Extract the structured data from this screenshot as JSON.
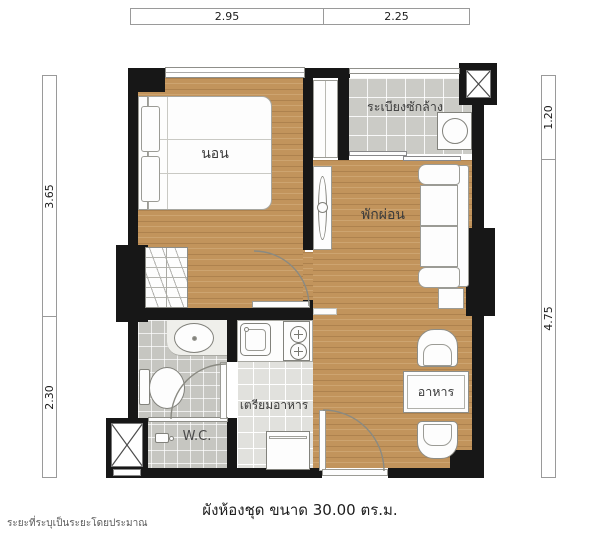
{
  "dimensions": {
    "top": [
      {
        "label": "2.95"
      },
      {
        "label": "2.25"
      }
    ],
    "left": [
      {
        "label": "3.65"
      },
      {
        "label": "2.30"
      }
    ],
    "right": [
      {
        "label": "1.20"
      },
      {
        "label": "4.75"
      }
    ]
  },
  "rooms": {
    "bedroom": "นอน",
    "laundry_balcony": "ระเบียงซักล้าง",
    "living": "พักผ่อน",
    "kitchen": "เตรียมอาหาร",
    "dining": "อาหาร",
    "wc": "W.C."
  },
  "caption": "ผังห้องชุด ขนาด 30.00 ตร.ม.",
  "footnote": "ระยะที่ระบุเป็นระยะโดยประมาณ",
  "colors": {
    "wood": "#c2945c",
    "tile_gray": "#c6c6c1",
    "tile_light": "#e1e1dd",
    "wall": "#171717"
  }
}
